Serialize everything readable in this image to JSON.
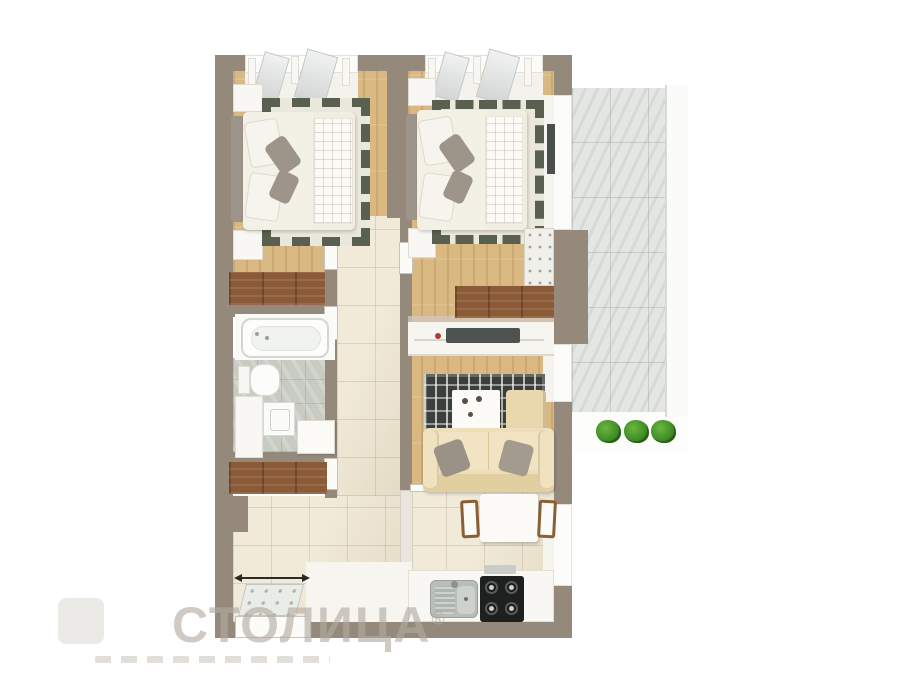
{
  "watermark": {
    "brand": "СТОЛИЦА",
    "registered": "®"
  },
  "palette": {
    "wall": "#95897c",
    "wood": "#d9b981",
    "woodDark": "#8b5a37",
    "tile": "#ece2cb",
    "marble": "#e3e6e2",
    "bathTile": "#c7cbc1",
    "rugBorder": "#59604f",
    "rugDark": "#3b403d",
    "sofa": "#eedfbb",
    "pouf": "#e9d8ae",
    "linen": "#f0ede2",
    "headboard": "#9d948a",
    "plant": "#3f8f27",
    "accent": "#b03a30",
    "watermark": "#b2aba1"
  },
  "scene": {
    "type": "3d-floor-plan-render",
    "rooms": [
      "bedroom-1",
      "bedroom-2",
      "bathroom",
      "hallway",
      "closet",
      "living-room",
      "kitchen-dining",
      "entry",
      "balcony"
    ],
    "plants_on_balcony": 3
  }
}
